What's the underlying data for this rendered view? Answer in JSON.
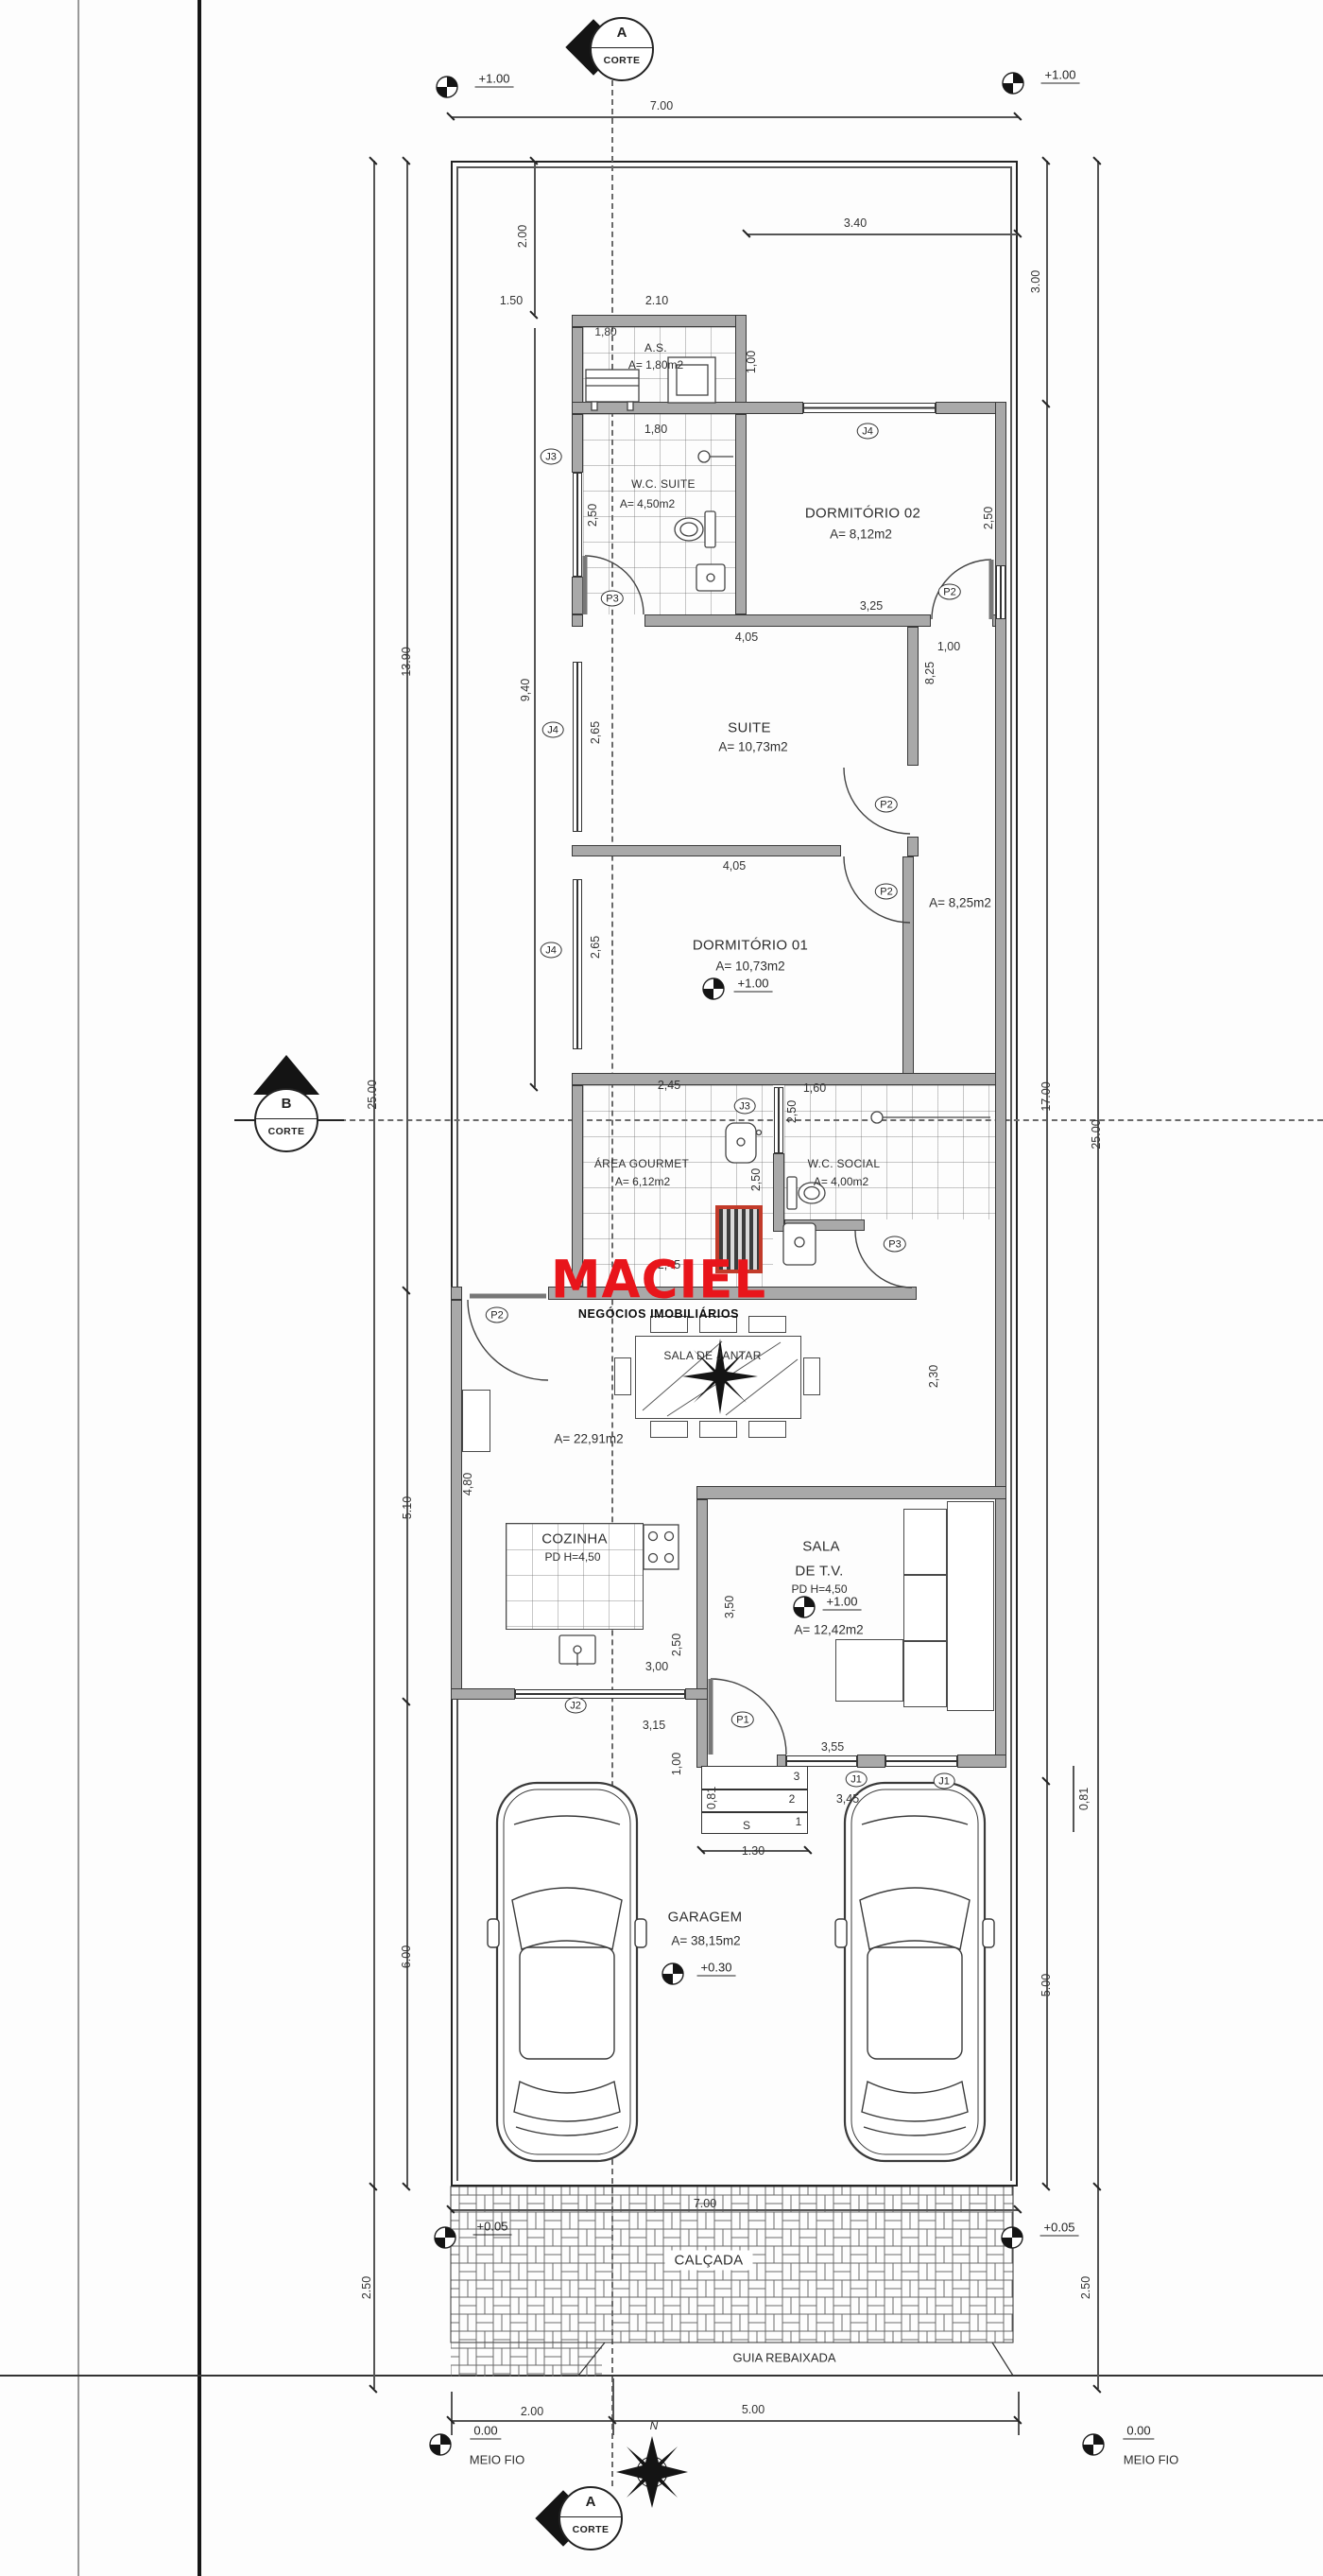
{
  "brand": {
    "name": "MACIEL",
    "tagline": "NEGÓCIOS IMOBILIÁRIOS",
    "color": "#e8151b"
  },
  "sections": {
    "a": "A",
    "b": "B",
    "corte": "CORTE"
  },
  "compass": {
    "n": "N"
  },
  "stairs": {
    "s": "S",
    "n1": "1",
    "n2": "2",
    "n3": "3"
  },
  "tags": {
    "j1": "J1",
    "j2": "J2",
    "j3": "J3",
    "j4": "J4",
    "p1": "P1",
    "p2": "P2",
    "p3": "P3"
  },
  "levels": {
    "plus_100": "+1.00",
    "plus_030": "+0.30",
    "plus_005": "+0.05",
    "zero": "0.00",
    "meio_fio": "MEIO FIO"
  },
  "rooms": {
    "as": {
      "name": "A.S.",
      "area": "A= 1,80m2"
    },
    "wc_suite": {
      "name": "W.C. SUITE",
      "area": "A= 4,50m2"
    },
    "dorm2": {
      "name": "DORMITÓRIO 02",
      "area": "A= 8,12m2"
    },
    "suite": {
      "name": "SUITE",
      "area": "A= 10,73m2"
    },
    "dorm1": {
      "name": "DORMITÓRIO 01",
      "area": "A= 10,73m2"
    },
    "hall": {
      "area": "A= 8,25m2"
    },
    "gourmet": {
      "name": "ÁREA GOURMET",
      "area": "A= 6,12m2"
    },
    "wc_social": {
      "name": "W.C. SOCIAL",
      "area": "A= 4,00m2"
    },
    "jantar": {
      "name": "SALA DE JANTAR",
      "area": "A= 22,91m2"
    },
    "cozinha": {
      "name": "COZINHA",
      "pd": "PD H=4,50"
    },
    "tv": {
      "line1": "SALA",
      "line2": "DE T.V.",
      "pd": "PD H=4,50",
      "area": "A= 12,42m2"
    },
    "garagem": {
      "name": "GARAGEM",
      "area": "A= 38,15m2"
    },
    "calcada": {
      "name": "CALÇADA"
    },
    "guia": {
      "name": "GUIA REBAIXADA"
    }
  },
  "dims": {
    "d700": "7.00",
    "d150": "1.50",
    "d210": "2.10",
    "d340": "3.40",
    "d200": "2.00",
    "d300": "3.00",
    "d100": "1,00",
    "d180": "1,80",
    "d250": "2,50",
    "d250dot": "2.50",
    "d325": "3,25",
    "d825": "8,25",
    "d405": "4,05",
    "d265": "2,65",
    "d940": "9,40",
    "d1390": "13.90",
    "d2500": "25.00",
    "d245": "2,45",
    "d160": "1,60",
    "d230": "2,30",
    "d480": "4,80",
    "d1700": "17.00",
    "d500": "5.00",
    "d510": "5.10",
    "d600": "6.00",
    "d350": "3,50",
    "d355": "3,55",
    "d345": "3,45",
    "d315": "3,15",
    "d300k": "3,00",
    "d081": "0,81",
    "d130": "1.30"
  }
}
